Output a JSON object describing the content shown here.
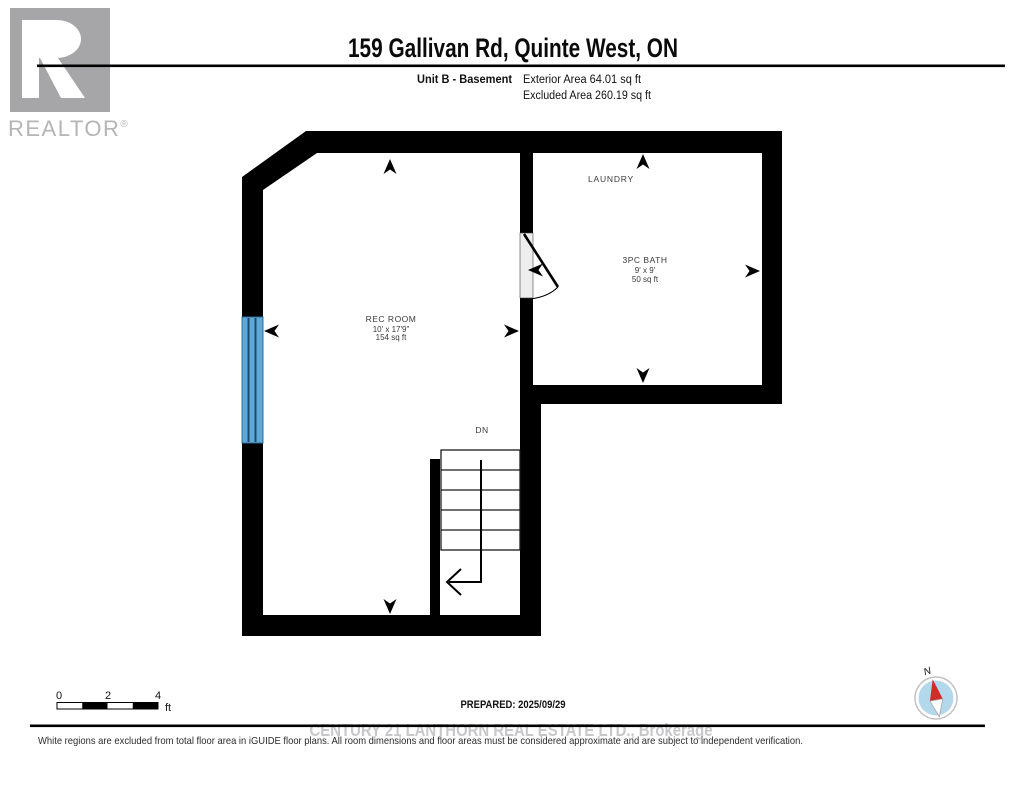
{
  "header": {
    "title": "159 Gallivan Rd, Quinte West, ON",
    "unit_label": "Unit B - Basement",
    "exterior_area": "Exterior Area 64.01 sq ft",
    "excluded_area": "Excluded Area 260.19 sq ft"
  },
  "brand": {
    "logo_letter": "R",
    "name": "REALTOR",
    "registered": "®"
  },
  "floorplan": {
    "rec_room": {
      "name": "REC ROOM",
      "dimensions": "10' x 17'9\"",
      "area": "154 sq ft"
    },
    "laundry": {
      "name": "LAUNDRY"
    },
    "bath": {
      "name": "3PC BATH",
      "dimensions": "9' x 9'",
      "area": "50 sq ft"
    },
    "stairs_label": "DN",
    "colors": {
      "wall": "#000000",
      "window_fill": "#5FA9D9",
      "window_line": "#1d4a6b",
      "door_jamb": "#ededed"
    }
  },
  "footer": {
    "scale_ticks": [
      "0",
      "2",
      "4"
    ],
    "scale_unit": "ft",
    "prepared": "PREPARED: 2025/09/29",
    "watermark": "CENTURY 21 LANTHORN REAL ESTATE LTD., Brokerage",
    "disclaimer": "White regions are excluded from total floor area in iGUIDE floor plans. All room dimensions and floor areas must be considered approximate and are subject to independent verification.",
    "compass_n": "N"
  }
}
